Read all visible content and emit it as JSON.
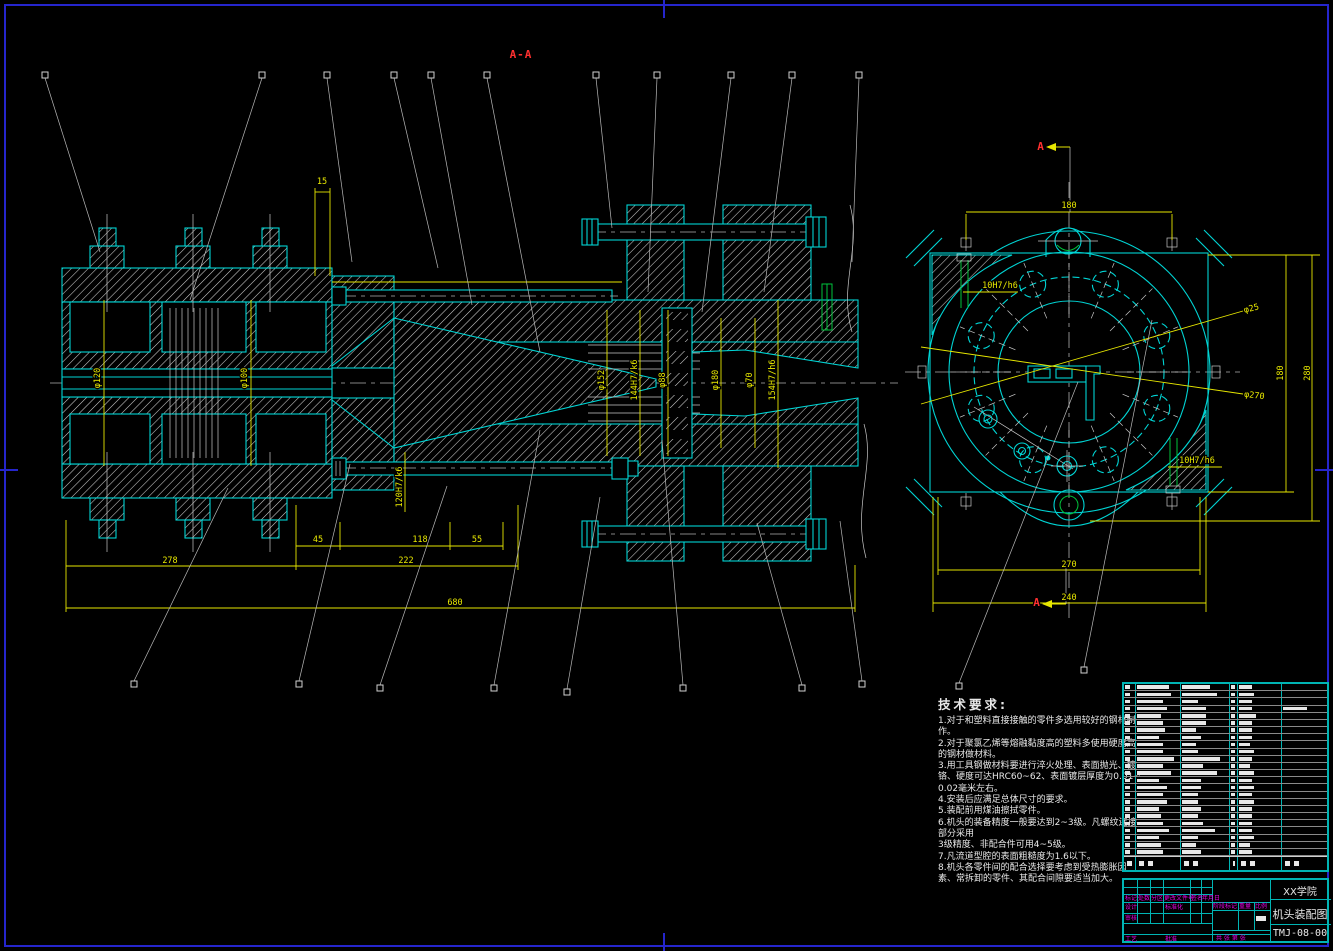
{
  "colors": {
    "cyan": "#00d4d4",
    "yellow": "#e6e600",
    "red": "#ff3030",
    "magenta": "#e800e8",
    "green": "#00c43c",
    "frame_blue": "#2525cc",
    "white": "#e8e8e8"
  },
  "dimensions": [
    {
      "t": "A-A",
      "x": 521,
      "y": 58,
      "r": 0,
      "c": "red",
      "n": "section-label-aa"
    },
    {
      "t": "A",
      "x": 1041,
      "y": 150,
      "r": 0,
      "c": "red",
      "n": "section-arrow-a-top"
    },
    {
      "t": "A",
      "x": 1037,
      "y": 606,
      "r": 0,
      "c": "red",
      "n": "section-arrow-a-bottom"
    },
    {
      "t": "15",
      "x": 322,
      "y": 184,
      "r": 0
    },
    {
      "t": "φ120",
      "x": 100,
      "y": 378,
      "r": -90
    },
    {
      "t": "φ100",
      "x": 247,
      "y": 378,
      "r": -90
    },
    {
      "t": "φ152",
      "x": 604,
      "y": 380,
      "r": -90
    },
    {
      "t": "144H7/k6",
      "x": 637,
      "y": 380,
      "r": -90
    },
    {
      "t": "φ88",
      "x": 665,
      "y": 380,
      "r": -90
    },
    {
      "t": "φ180",
      "x": 718,
      "y": 380,
      "r": -90
    },
    {
      "t": "φ70",
      "x": 752,
      "y": 380,
      "r": -90
    },
    {
      "t": "154H7/h6",
      "x": 775,
      "y": 380,
      "r": -90
    },
    {
      "t": "120H7/k6",
      "x": 402,
      "y": 487,
      "r": -90
    },
    {
      "t": "45",
      "x": 318,
      "y": 542,
      "r": 0
    },
    {
      "t": "118",
      "x": 420,
      "y": 542,
      "r": 0
    },
    {
      "t": "55",
      "x": 477,
      "y": 542,
      "r": 0
    },
    {
      "t": "278",
      "x": 170,
      "y": 563,
      "r": 0
    },
    {
      "t": "222",
      "x": 406,
      "y": 563,
      "r": 0
    },
    {
      "t": "680",
      "x": 455,
      "y": 605,
      "r": 0
    },
    {
      "t": "180",
      "x": 1069,
      "y": 208,
      "r": 0
    },
    {
      "t": "10H7/h6",
      "x": 1000,
      "y": 288,
      "r": 0
    },
    {
      "t": "10H7/h6",
      "x": 1197,
      "y": 463,
      "r": 0
    },
    {
      "t": "φ25",
      "x": 1252,
      "y": 311,
      "r": -14
    },
    {
      "t": "φ270",
      "x": 1254,
      "y": 398,
      "r": 7
    },
    {
      "t": "180",
      "x": 1283,
      "y": 373,
      "r": -90
    },
    {
      "t": "280",
      "x": 1310,
      "y": 373,
      "r": -90
    },
    {
      "t": "270",
      "x": 1069,
      "y": 567,
      "r": 0
    },
    {
      "t": "240",
      "x": 1069,
      "y": 600,
      "r": 0
    }
  ],
  "tech_requirements": {
    "title": "技术要求:",
    "lines": [
      "1.对于和塑料直接接触的零件多选用较好的钢材制",
      "作。",
      "2.对于聚氯乙烯等熔融黏度高的塑料多使用硬度高",
      "的钢材做材料。",
      "3.用工具钢做材料要进行淬火处理、表面抛光、镀",
      "铬、硬度可达HRC60~62、表面镀层厚度为0.01~",
      "0.02毫米左右。",
      "4.安装后应满足总体尺寸的要求。",
      "5.装配前用煤油擦拭零件。",
      "6.机头的装备精度一般要达到2~3级。凡螺纹连接",
      "部分采用",
      "3级精度、非配合件可用4~5级。",
      "7.凡流道型腔的表面粗糙度为1.6以下。",
      "8.机头各零件间的配合选择要考虑到受热膨胀因",
      "素、常拆卸的零件、其配合间隙要适当加大。"
    ]
  },
  "parts_table": {
    "rows": [
      [
        0.5,
        0.75,
        0.6,
        0.6,
        0.3,
        0
      ],
      [
        0.5,
        0.8,
        0.75,
        0.6,
        0.35,
        0
      ],
      [
        0.5,
        0.6,
        0.35,
        0.6,
        0.3,
        0
      ],
      [
        0.5,
        0.7,
        0.5,
        0.6,
        0.3,
        0.55
      ],
      [
        0.5,
        0.55,
        0.5,
        0.6,
        0.4,
        0
      ],
      [
        0.5,
        0.6,
        0.5,
        0.6,
        0.3,
        0
      ],
      [
        0.5,
        0.65,
        0.3,
        0.6,
        0.3,
        0
      ],
      [
        0.5,
        0.5,
        0.4,
        0.6,
        0.3,
        0
      ],
      [
        0.5,
        0.6,
        0.3,
        0.6,
        0.25,
        0
      ],
      [
        0.5,
        0.6,
        0.35,
        0.6,
        0.35,
        0
      ],
      [
        0.5,
        0.85,
        0.8,
        0.6,
        0.3,
        0
      ],
      [
        0.5,
        0.6,
        0.45,
        0.6,
        0.25,
        0
      ],
      [
        0.5,
        0.8,
        0.75,
        0.6,
        0.35,
        0
      ],
      [
        0.5,
        0.5,
        0.4,
        0.6,
        0.3,
        0
      ],
      [
        0.5,
        0.7,
        0.4,
        0.6,
        0.35,
        0
      ],
      [
        0.5,
        0.6,
        0.35,
        0.6,
        0.3,
        0
      ],
      [
        0.5,
        0.7,
        0.35,
        0.6,
        0.35,
        0
      ],
      [
        0.5,
        0.5,
        0.4,
        0.6,
        0.3,
        0
      ],
      [
        0.5,
        0.55,
        0.35,
        0.6,
        0.3,
        0
      ],
      [
        0.5,
        0.6,
        0.45,
        0.6,
        0.3,
        0
      ],
      [
        0.5,
        0.75,
        0.7,
        0.6,
        0.3,
        0
      ],
      [
        0.5,
        0.5,
        0.35,
        0.6,
        0.35,
        0
      ],
      [
        0.5,
        0.55,
        0.3,
        0.6,
        0.25,
        0
      ],
      [
        0.5,
        0.6,
        0.4,
        0.6,
        0.3,
        0
      ]
    ]
  },
  "title_block": {
    "company": "XX学院",
    "drawing_title": "机头装配图",
    "drawing_no": "TMJ-08-00",
    "mark": "标记",
    "count": "处数",
    "zone": "分区",
    "change_file": "更改文件号",
    "sign": "签名",
    "date": "年月日",
    "design": "设计",
    "standardization": "标准化",
    "stage_mark": "阶段标记",
    "weight": "重量",
    "scale": "比例",
    "audit": "审核",
    "process": "工艺",
    "approve": "批准",
    "sheets": "共 张 第 张"
  }
}
